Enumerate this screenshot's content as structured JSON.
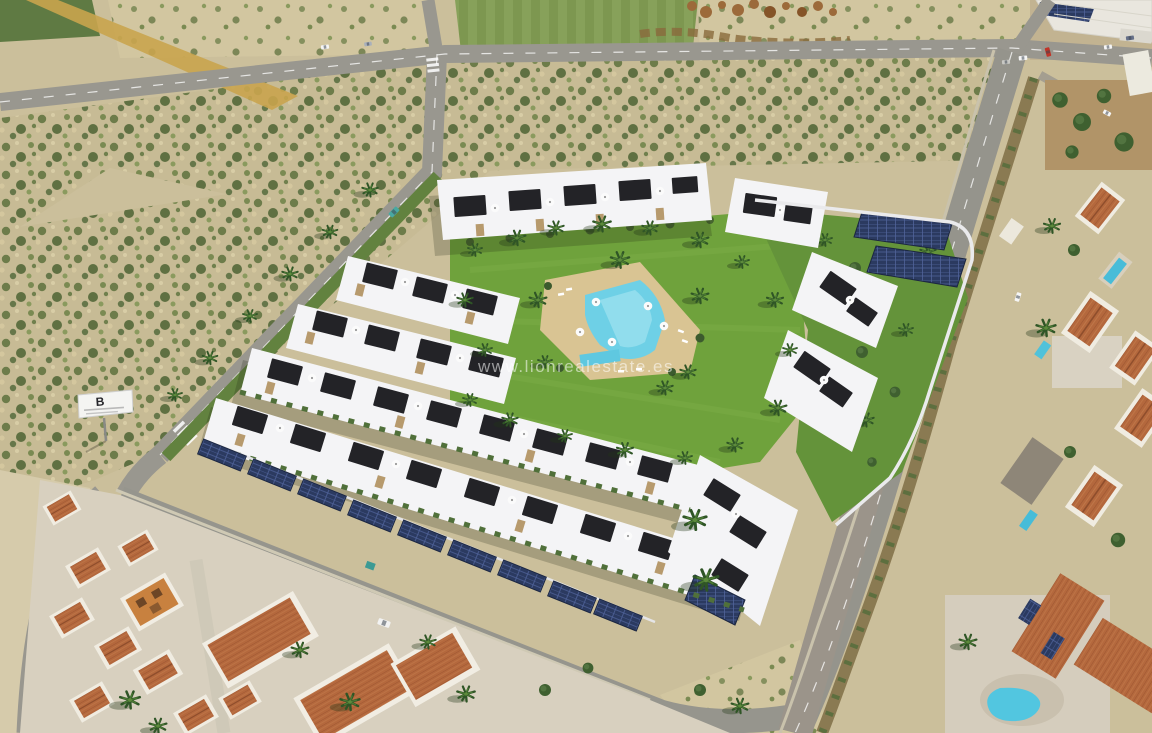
{
  "scene": {
    "type": "aerial-photograph",
    "subject": "Aerial view of a modern white residential development with a central communal pool, lawned gardens, palm trees and solar-panel carports, bordered by roads and vacant scrubland plots, an industrial unit at top right, and established neighbourhoods of villas with terracotta roofs and private pools"
  },
  "watermark": {
    "text": "www.lionrealestate.es",
    "color": "#ffffff"
  },
  "billboard": {
    "letter": "B"
  },
  "colors": {
    "sand": "#cbbf9b",
    "scrub_green": "#6d7c4a",
    "asphalt": "#99978f",
    "road_marking": "#ffffff",
    "lawn_green": "#6fa23c",
    "pool_blue": "#6ed0e6",
    "deck_beige": "#d9c493",
    "building_white": "#f4f4f6",
    "building_dark": "#232327",
    "solar_panel_blue": "#2b3a60",
    "terracotta_roof": "#b4683d",
    "hedge_green": "#46652f"
  }
}
